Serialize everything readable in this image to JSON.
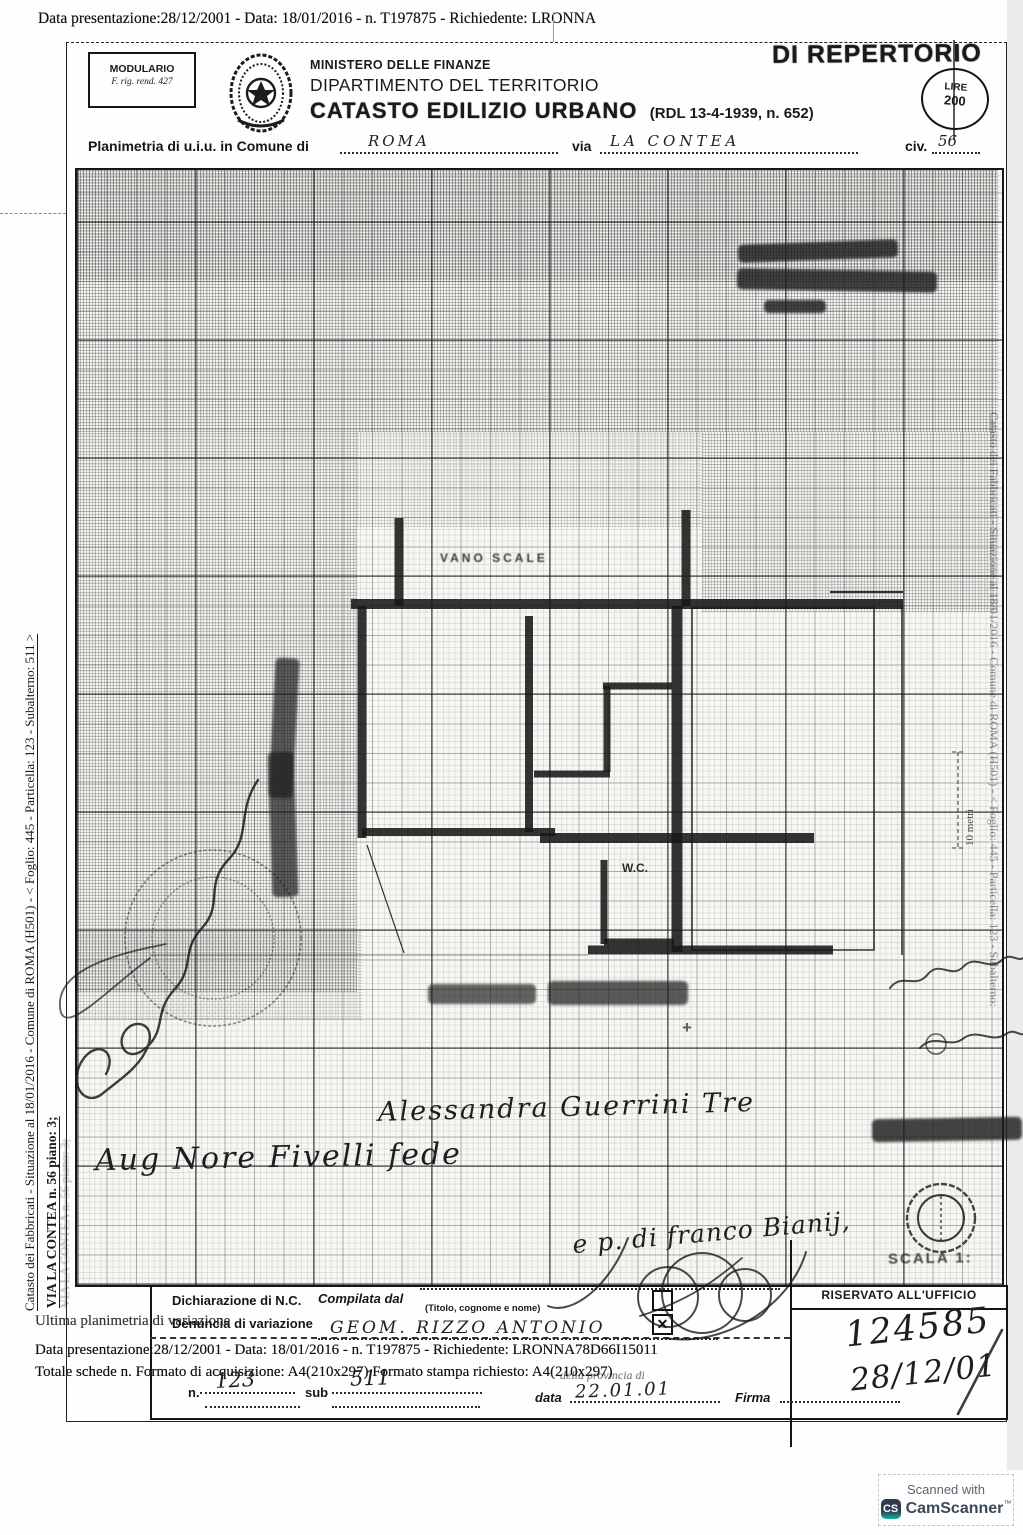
{
  "page": {
    "top_line": "Data presentazione:28/12/2001 - Data: 18/01/2016 - n. T197875 - Richiedente: LRONNA"
  },
  "header": {
    "modulario1": "MODULARIO",
    "modulario2": "F. rig. rend. 427",
    "ministero": "MINISTERO DELLE FINANZE",
    "dipartimento": "DIPARTIMENTO DEL TERRITORIO",
    "catasto": "CATASTO EDILIZIO URBANO",
    "rdl": "(RDL 13-4-1939, n. 652)",
    "repertorio": "DI REPERTORIO",
    "lire1": "LIRE",
    "lire2": "200"
  },
  "location": {
    "label_comune": "Planimetria di u.i.u. in Comune di",
    "comune": "ROMA",
    "label_via": "via",
    "via": "LA CONTEA",
    "label_civ": "civ.",
    "civ": "56"
  },
  "margin": {
    "line1": "Catasto dei Fabbricati - Situazione al 18/01/2016 - Comune di ROMA (H501) - < Foglio: 445 - Particella: 123 - Subalterno: 511 >",
    "line2": "VIA LA CONTEA n. 56 piano: 3;"
  },
  "plan": {
    "vano_label": "VANO SCALE",
    "wc_label": "W.C.",
    "scale_label": "10 metri",
    "scala_stamp": "SCALA 1:"
  },
  "signatures": {
    "sig_center": "Alessandra Guerrini Tre",
    "sig_left": "Aug Nore Fivelli fede",
    "sig_tecnico": "e p. di franco Bianij,"
  },
  "form": {
    "dichiarazione": "Dichiarazione di N.C.",
    "denuncia": "Denuncia di variazione",
    "compilata": "Compilata dal",
    "titolo_note": "(Titolo, cognome e nome)",
    "compilatore": "GEOM. RIZZO ANTONIO",
    "data_label": "data",
    "data_value": "22.01.01",
    "firma_label": "Firma",
    "n_label": "n.",
    "n_value": "123",
    "sub_label": "sub",
    "sub_value": "511",
    "riservato": "RISERVATO ALL'UFFICIO",
    "protocollo": "124585",
    "data_protocollo": "28/12/01"
  },
  "ghost": {
    "line1": "Ultima planimetria di variazione",
    "line2": "Data presentazione:28/12/2001 - Data: 18/01/2016 - n. T197875 - Richiedente: LRONNA78D66I15011",
    "line3": "Totale schede n. Formato di acquisizione: A4(210x297) Formato stampa richiesto: A4(210x297)",
    "line4": "della provincia di"
  },
  "icons": {
    "check": "✕",
    "plus": "+",
    "cs": "CS"
  },
  "footer": {
    "scanned_with": "Scanned with",
    "camscanner": "CamScanner",
    "tm": "™"
  }
}
